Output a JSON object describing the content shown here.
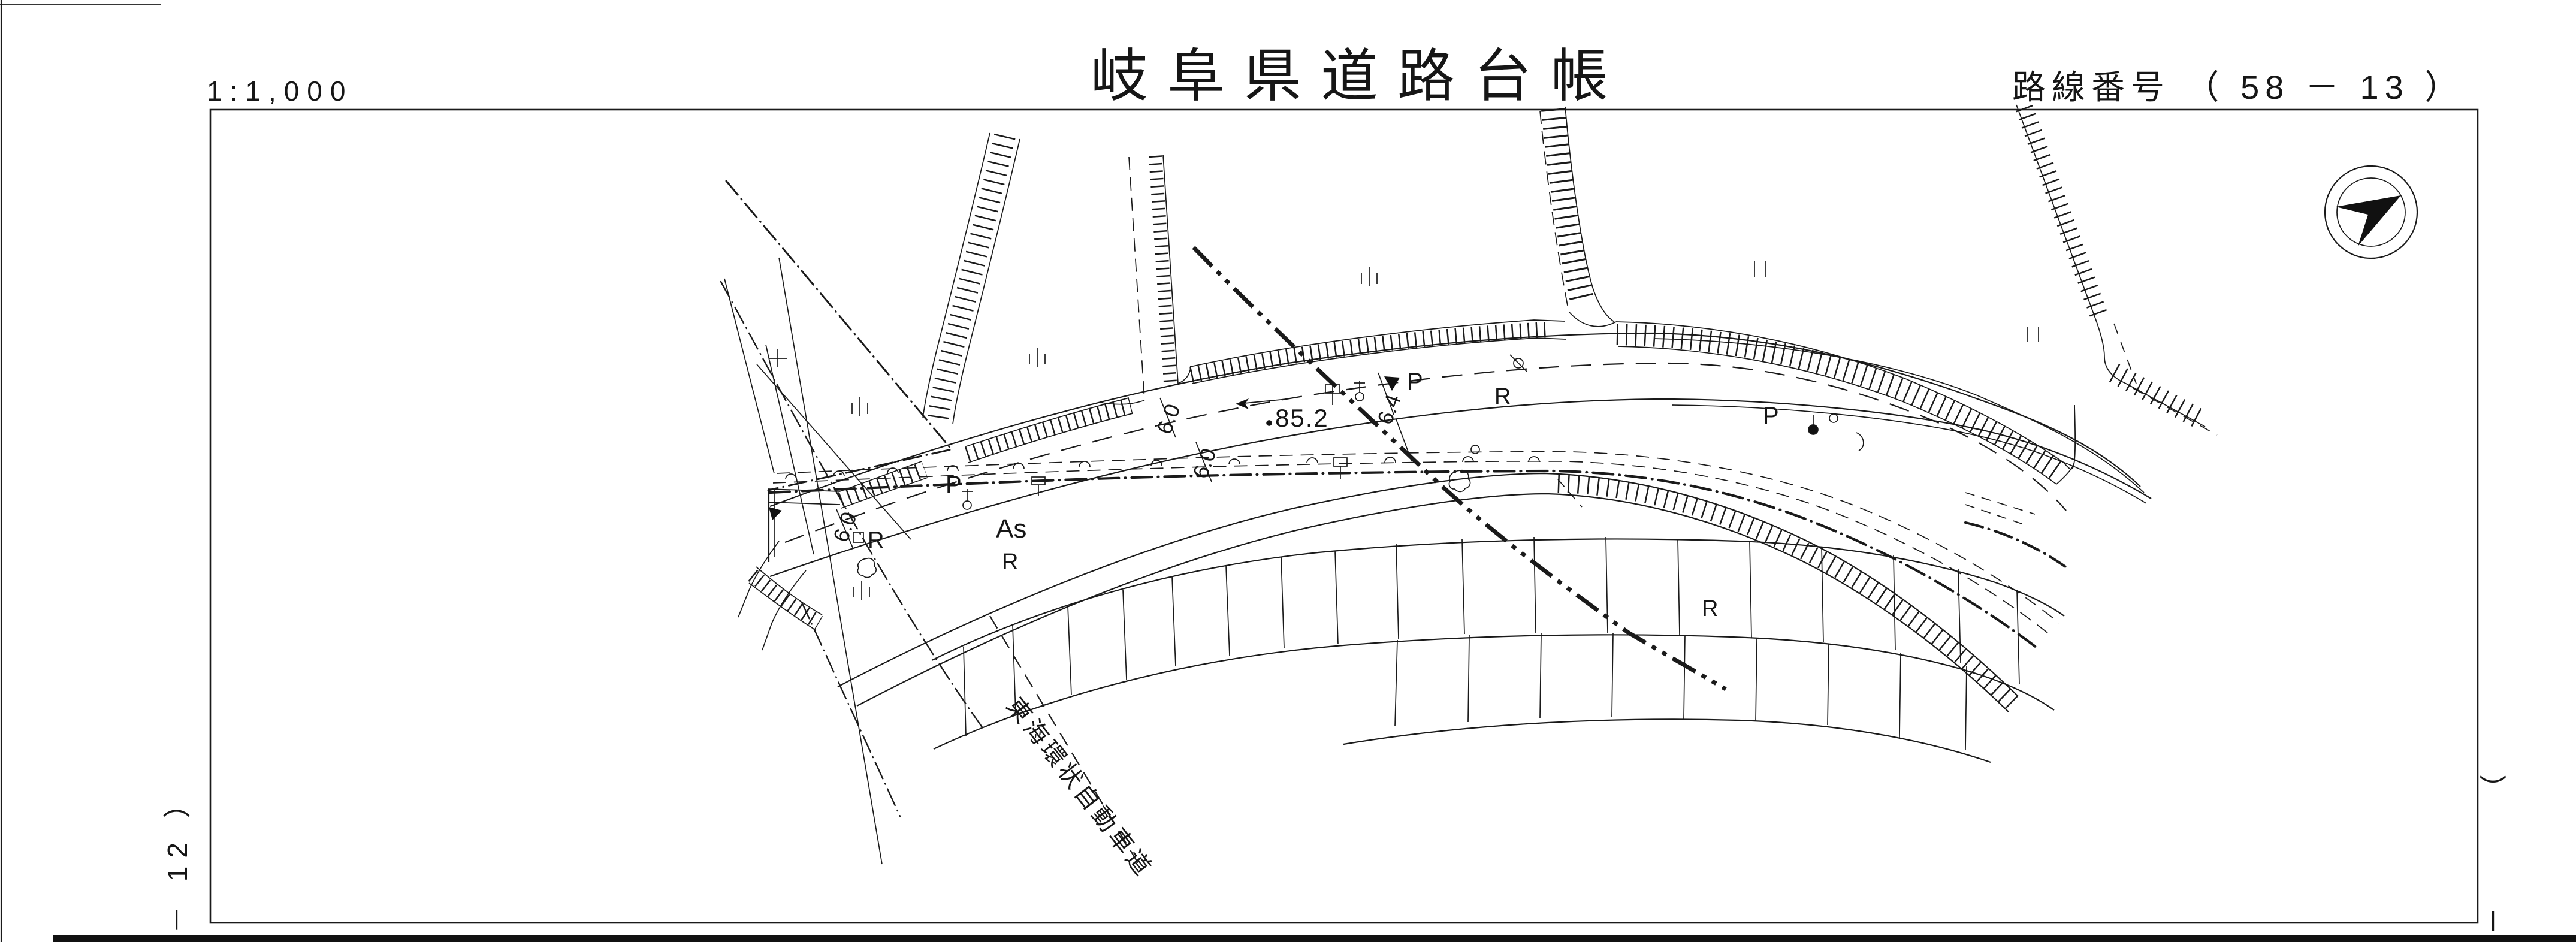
{
  "header": {
    "scale_label": "1:1,000",
    "title": "岐阜県道路台帳",
    "route_number_label": "路線番号 （ 58 － 13 ）"
  },
  "sheet_refs": {
    "left_label": "－ 12 ）",
    "right_paren": "（",
    "right_dash": "－"
  },
  "annotations": {
    "road_name": "東海環状自動車道",
    "surface": "As",
    "spot_elevation": "85.2",
    "dim_lane_left": "6.0",
    "dim_lane_a": "6.0",
    "dim_lane_b": "6.0",
    "dim_widening": "6.4",
    "pole_label_1": "P",
    "pole_label_2": "P",
    "pole_label_3": "P",
    "r_label_1": "R",
    "r_label_2": "R",
    "r_label_3": "R",
    "r_label_4": "R"
  },
  "icons": {
    "north_arrow": "north-arrow"
  },
  "colors": {
    "ink": "#1a1a1a",
    "paper": "#ffffff"
  }
}
